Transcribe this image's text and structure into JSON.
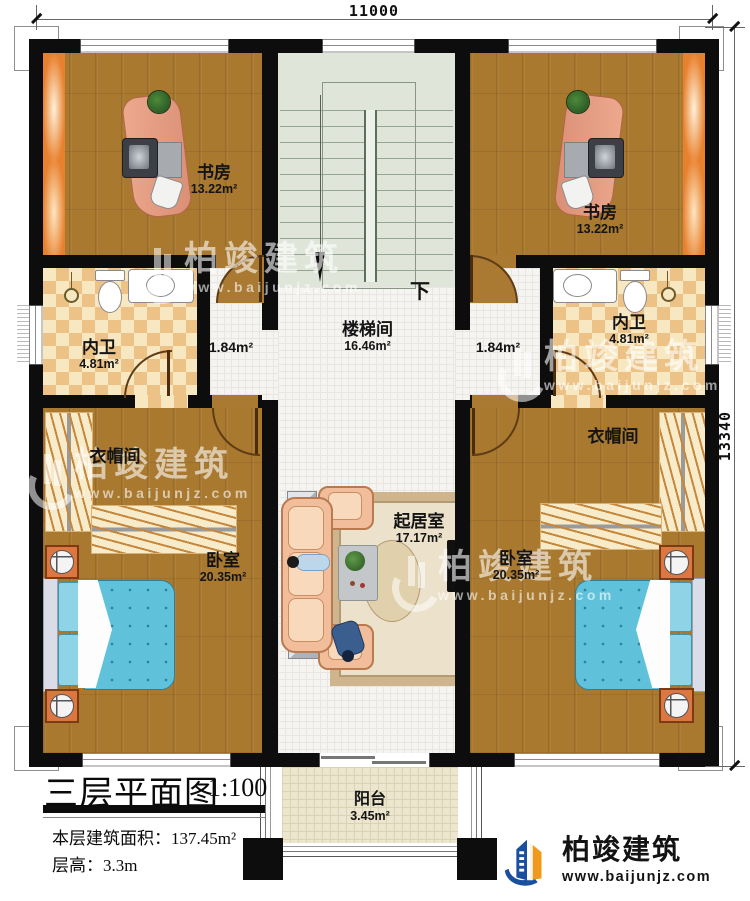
{
  "plan": {
    "dimensions": {
      "width_mm": "11000",
      "height_mm": "13340"
    },
    "rooms": {
      "study_left": {
        "name": "书房",
        "area": "13.22m²"
      },
      "study_right": {
        "name": "书房",
        "area": "13.22m²"
      },
      "bath_left": {
        "name": "内卫",
        "area": "4.81m²"
      },
      "bath_right": {
        "name": "内卫",
        "area": "4.81m²"
      },
      "corridor_left": {
        "area": "1.84m²"
      },
      "corridor_right": {
        "area": "1.84m²"
      },
      "stairwell": {
        "name": "楼梯间",
        "area": "16.46m²",
        "direction": "下"
      },
      "closet_left": {
        "name": "衣帽间"
      },
      "closet_right": {
        "name": "衣帽间"
      },
      "bedroom_left": {
        "name": "卧室",
        "area": "20.35m²"
      },
      "bedroom_right": {
        "name": "卧室",
        "area": "20.35m²"
      },
      "living": {
        "name": "起居室",
        "area": "17.17m²"
      },
      "balcony": {
        "name": "阳台",
        "area": "3.45m²"
      }
    },
    "title_block": {
      "title": "三层平面图",
      "scale": "1:100",
      "floor_area_line": "本层建筑面积：137.45m²",
      "floor_height_line": "层高：3.3m"
    },
    "branding": {
      "company": "柏竣建筑",
      "website": "www.baijunjz.com"
    },
    "watermark": {
      "company": "柏竣建筑",
      "website": "www.baijunjz.com"
    },
    "colors": {
      "wall": "#0d0d0d",
      "wood": "#a8792f",
      "stair": "#e0e5da",
      "checker": "#ecc286",
      "bed": "#5fc2da",
      "accent": "#e8812e",
      "logo_blue": "#1a4e9e",
      "logo_orange": "#f2991d"
    }
  }
}
